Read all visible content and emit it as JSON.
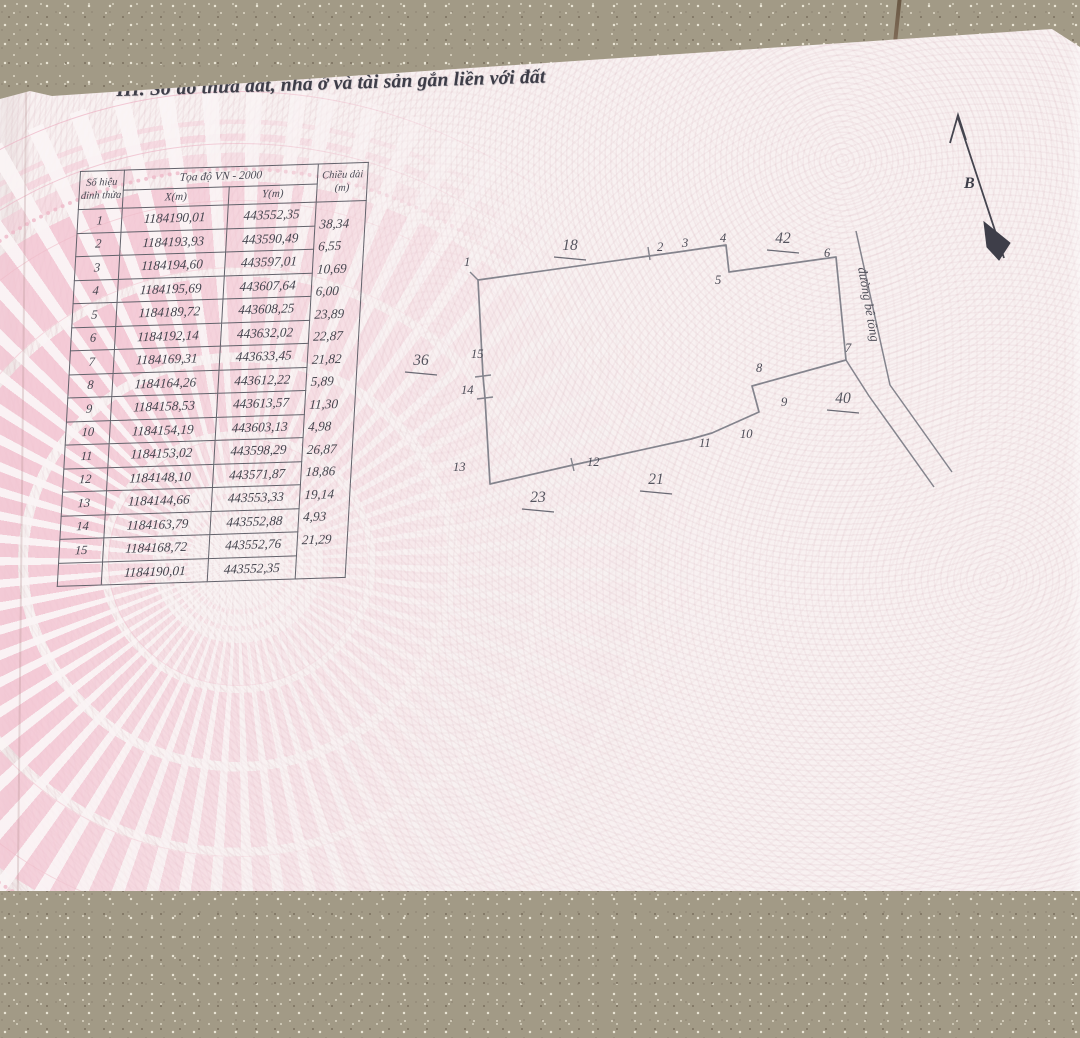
{
  "page": {
    "section_title": "III. Sơ đồ thửa đất, nhà ở và tài sản gắn liền với đất"
  },
  "coordinate_table": {
    "header": {
      "col_vertex_line1": "Số hiệu",
      "col_vertex_line2": "đỉnh thửa",
      "col_coord_group": "Tọa độ VN - 2000",
      "col_x": "X(m)",
      "col_y": "Y(m)",
      "col_length_line1": "Chiều dài",
      "col_length_line2": "(m)"
    },
    "rows": [
      {
        "no": "1",
        "x": "1184190,01",
        "y": "443552,35"
      },
      {
        "no": "2",
        "x": "1184193,93",
        "y": "443590,49"
      },
      {
        "no": "3",
        "x": "1184194,60",
        "y": "443597,01"
      },
      {
        "no": "4",
        "x": "1184195,69",
        "y": "443607,64"
      },
      {
        "no": "5",
        "x": "1184189,72",
        "y": "443608,25"
      },
      {
        "no": "6",
        "x": "1184192,14",
        "y": "443632,02"
      },
      {
        "no": "7",
        "x": "1184169,31",
        "y": "443633,45"
      },
      {
        "no": "8",
        "x": "1184164,26",
        "y": "443612,22"
      },
      {
        "no": "9",
        "x": "1184158,53",
        "y": "443613,57"
      },
      {
        "no": "10",
        "x": "1184154,19",
        "y": "443603,13"
      },
      {
        "no": "11",
        "x": "1184153,02",
        "y": "443598,29"
      },
      {
        "no": "12",
        "x": "1184148,10",
        "y": "443571,87"
      },
      {
        "no": "13",
        "x": "1184144,66",
        "y": "443553,33"
      },
      {
        "no": "14",
        "x": "1184163,79",
        "y": "443552,88"
      },
      {
        "no": "15",
        "x": "1184168,72",
        "y": "443552,76"
      },
      {
        "no": "",
        "x": "1184190,01",
        "y": "443552,35"
      }
    ],
    "edge_lengths": [
      "38,34",
      "6,55",
      "10,69",
      "6,00",
      "23,89",
      "22,87",
      "21,82",
      "5,89",
      "11,30",
      "4,98",
      "26,87",
      "18,86",
      "19,14",
      "4,93",
      "21,29"
    ]
  },
  "diagram": {
    "parcel_vertices": [
      {
        "id": "1",
        "px": 478,
        "py": 280,
        "lx": 464,
        "ly": 266
      },
      {
        "id": "2",
        "px": 649,
        "py": 256,
        "lx": 657,
        "ly": 251
      },
      {
        "id": "3",
        "px": 678,
        "py": 252,
        "lx": 682,
        "ly": 247
      },
      {
        "id": "4",
        "px": 726,
        "py": 245,
        "lx": 720,
        "ly": 242
      },
      {
        "id": "5",
        "px": 729,
        "py": 272,
        "lx": 715,
        "ly": 284
      },
      {
        "id": "6",
        "px": 836,
        "py": 257,
        "lx": 824,
        "ly": 257
      },
      {
        "id": "7",
        "px": 846,
        "py": 360,
        "lx": 845,
        "ly": 352
      },
      {
        "id": "8",
        "px": 752,
        "py": 386,
        "lx": 756,
        "ly": 372
      },
      {
        "id": "9",
        "px": 759,
        "py": 412,
        "lx": 781,
        "ly": 406
      },
      {
        "id": "10",
        "px": 712,
        "py": 433,
        "lx": 740,
        "ly": 438
      },
      {
        "id": "11",
        "px": 691,
        "py": 439,
        "lx": 699,
        "ly": 447
      },
      {
        "id": "12",
        "px": 573,
        "py": 465,
        "lx": 587,
        "ly": 466
      },
      {
        "id": "13",
        "px": 490,
        "py": 484,
        "lx": 453,
        "ly": 471
      },
      {
        "id": "14",
        "px": 485,
        "py": 398,
        "lx": 461,
        "ly": 394
      },
      {
        "id": "15",
        "px": 483,
        "py": 376,
        "lx": 471,
        "ly": 358
      }
    ],
    "ticks": [
      [
        648,
        247,
        650,
        260
      ],
      [
        571,
        458,
        574,
        471
      ],
      [
        477,
        399,
        493,
        397
      ],
      [
        475,
        377,
        491,
        375
      ],
      [
        470,
        272,
        478,
        280
      ]
    ],
    "road_lines": [
      [
        [
          856,
          231
        ],
        [
          890,
          385
        ],
        [
          952,
          472
        ]
      ],
      [
        [
          846,
          360
        ],
        [
          869,
          396
        ],
        [
          934,
          487
        ]
      ]
    ],
    "adjacent_parcels": [
      {
        "label": "18",
        "x": 570,
        "y": 250
      },
      {
        "label": "42",
        "x": 783,
        "y": 243
      },
      {
        "label": "36",
        "x": 421,
        "y": 365
      },
      {
        "label": "40",
        "x": 843,
        "y": 403
      },
      {
        "label": "21",
        "x": 656,
        "y": 484
      },
      {
        "label": "23",
        "x": 538,
        "y": 502
      }
    ],
    "road_label": "đường bê tông",
    "road_label_pos": [
      858,
      268
    ],
    "road_label_rot": 80,
    "north_label": "B"
  },
  "colors": {
    "paper": "#f8f1f1",
    "emblem_pink": "#f3c4d2",
    "ink": "#44444e",
    "line_gray": "#84848d",
    "floor": "#a29a86"
  }
}
